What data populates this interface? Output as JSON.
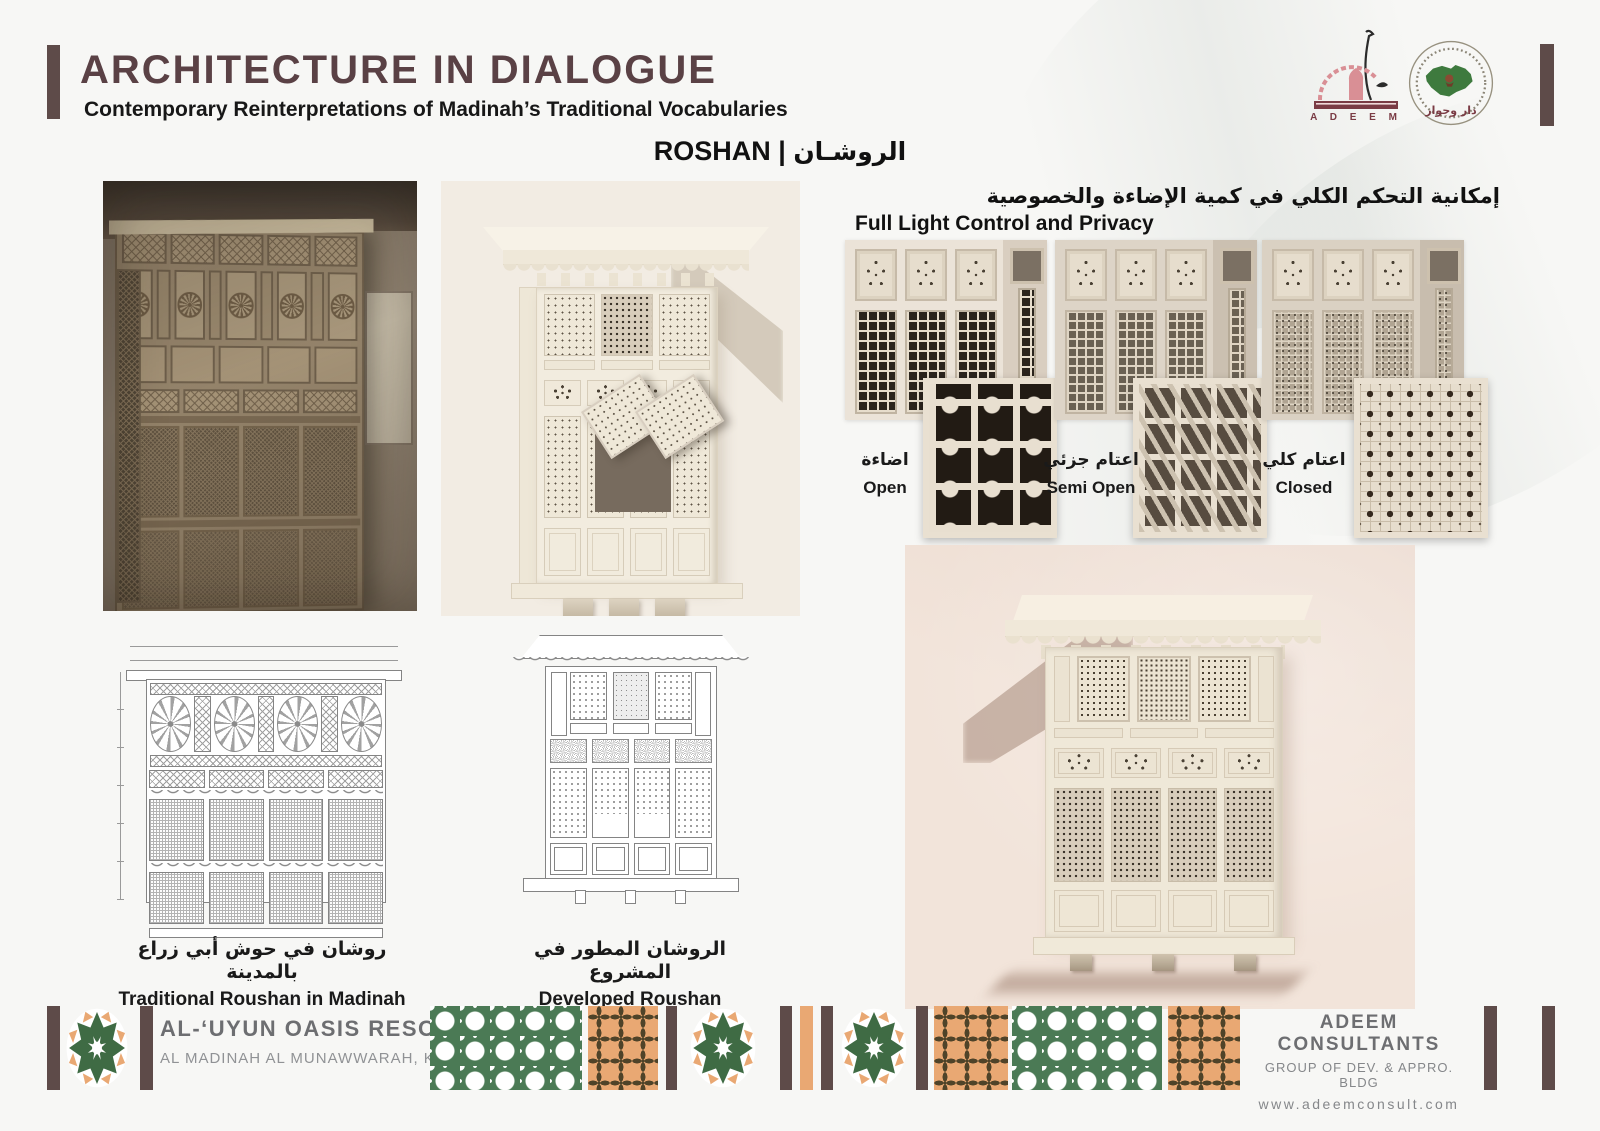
{
  "header": {
    "title": "ARCHITECTURE IN DIALOGUE",
    "subtitle": "Contemporary Reinterpretations of Madinah’s Traditional Vocabularies"
  },
  "logos": {
    "adeem_text": "A D E E M",
    "dar_text": "دار وجوار"
  },
  "section": {
    "title_en": "ROSHAN",
    "separator": "|",
    "title_ar": "الروشـان"
  },
  "light_control": {
    "title_ar": "إمكانية التحكم الكلي في كمية الإضاءة والخصوصية",
    "title_en": "Full Light Control and Privacy",
    "states": [
      {
        "label_ar": "اضاءة",
        "label_en": "Open"
      },
      {
        "label_ar": "اعتام جزئي",
        "label_en": "Semi Open"
      },
      {
        "label_ar": "اعتام كلي",
        "label_en": "Closed"
      }
    ]
  },
  "captions": {
    "traditional_ar": "روشان في حوش أبي زراع بالمدينة",
    "traditional_en": "Traditional Roushan in Madinah",
    "developed_ar": "الروشان المطور في المشروع",
    "developed_en": "Developed Roushan"
  },
  "footer": {
    "project_name": "AL-‘UYUN OASIS RESORT",
    "project_location": "AL MADINAH AL MUNAWWARAH, KSA",
    "company_name": "ADEEM CONSULTANTS",
    "company_group": "GROUP OF DEV. & APPRO. BLDG",
    "company_site": "www.adeemconsult.com"
  },
  "colors": {
    "accent_brown": "#5e4b49",
    "title_brown": "#5a4145",
    "footer_green": "#4b7a55",
    "footer_orange": "#e9a873",
    "logo_maroon": "#7a3b44",
    "render_beige": "#f2ece3",
    "wall_pink": "#f2e4da"
  }
}
